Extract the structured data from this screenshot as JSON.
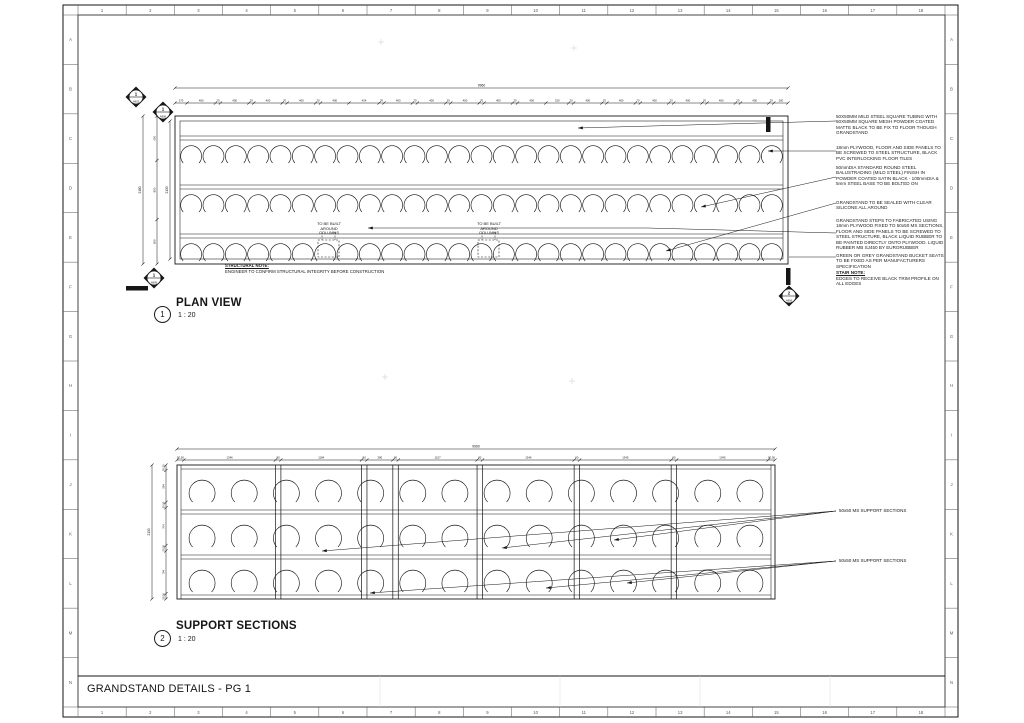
{
  "sheet": {
    "title": "GRANDSTAND DETAILS - PG 1",
    "grid_numbers": [
      "1",
      "2",
      "3",
      "4",
      "5",
      "6",
      "7",
      "8",
      "9",
      "10",
      "11",
      "12",
      "13",
      "14",
      "15",
      "16",
      "17",
      "18"
    ],
    "grid_letters": [
      "A",
      "B",
      "C",
      "D",
      "E",
      "F",
      "G",
      "H",
      "I",
      "J",
      "K",
      "L",
      "M",
      "N"
    ]
  },
  "views": {
    "plan": {
      "number": "1",
      "title": "PLAN VIEW",
      "scale": "1 : 20"
    },
    "support": {
      "number": "2",
      "title": "SUPPORT SECTIONS",
      "scale": "1 : 20"
    }
  },
  "notes": [
    {
      "text": "50X50MM MILD STEEL SQUARE TUBING WITH 50X50MM SQUARE MESH POWDER COATED MATTE BLACK TO BE FIX TO FLOOR THOUGH GRANDSTAND"
    },
    {
      "text": "18mm PLYWOOD, FLOOR AND SIDE PANELS TO BE SCREWED TO STEEL STRUCTURE, BLACK PVC INTERLOCKING FLOOR TILES"
    },
    {
      "text": "50mmDIA STANDARD ROUND STEEL BALUSTRADING (MILD STEEL) FINISH IN POWDER COATED SATIN BLACK - 100mmDIA & 5mm STEEL BASE TO BE BOLTED ON"
    },
    {
      "text": "GRANDSTAND TO BE SEALED WITH CLEAR SILICONE ALL AROUND"
    },
    {
      "text": "GRANDSTAND STEPS TO FABRICATED USING 18mm PLYWOOD FIXED TO 50x50 MS SECTIONS, FLOOR AND SIDE PANELS TO BE SCREWED TO STEEL STRUCTURE, BLACK LIQUID RUBBER TO BE PAINTED DIRECTLY ONTO PLYWOOD. LIQUID RUBBER MB SJ450 BY EURORUBBER"
    },
    {
      "text": "GREEN OR GREY GRANDSTAND BUCKET SEATS TO BE FIXED AS PER MANUFACTURERS SPECIFICATION"
    }
  ],
  "annotations": {
    "stair_note_title": "STAIR NOTE:",
    "stair_note_body": "EDGES TO RECEIVE BLACK TRIM PROFILE ON ALL EDGES",
    "column_note_1": "TO BE BUILT AROUND COLUMNS",
    "column_note_2": "TO BE BUILT AROUND COLUMNS",
    "structural_note_title": "STRUCTURAL NOTE:",
    "structural_note_body": "ENGINEER TO CONFIRM STRUCTURAL INTEGRITY BEFORE CONSTRUCTION",
    "support_label_1": "50x50 MS SUPPORT SECTIONS",
    "support_label_2": "50x50 MS SUPPORT SECTIONS"
  },
  "markers": [
    {
      "num": "1",
      "ref": "A902"
    },
    {
      "num": "1",
      "ref": "A906"
    },
    {
      "num": "1",
      "ref": "A906"
    },
    {
      "num": "2",
      "ref": "A906"
    }
  ],
  "dimensions": {
    "plan": {
      "total": "9960",
      "top_labels": [
        "170",
        "400",
        "70",
        "400",
        "70",
        "400",
        "70",
        "400",
        "70",
        "400",
        "424",
        "70",
        "400",
        "70",
        "400",
        "70",
        "400",
        "70",
        "400",
        "70",
        "400",
        "320",
        "70",
        "400",
        "70",
        "400",
        "70",
        "400",
        "70",
        "400",
        "70",
        "400",
        "70",
        "400",
        "70",
        "200"
      ],
      "top_values": [
        170,
        400,
        70,
        400,
        70,
        400,
        70,
        400,
        70,
        400,
        424,
        70,
        400,
        70,
        400,
        70,
        400,
        70,
        400,
        70,
        400,
        320,
        70,
        400,
        70,
        400,
        70,
        400,
        70,
        400,
        70,
        400,
        70,
        400,
        70,
        200
      ],
      "left_total": "2180",
      "left_labels": [
        "600",
        "800",
        "600"
      ],
      "left_values": [
        600,
        800,
        600
      ],
      "left_inner_total": "2130"
    },
    "support": {
      "total": "9960",
      "top_labels": [
        "50,50",
        "1346",
        "80",
        "1184",
        "80",
        "380",
        "80",
        "1157",
        "80",
        "1346",
        "80",
        "1345",
        "80",
        "1345",
        "80,50"
      ],
      "top_values": [
        100,
        1346,
        80,
        1184,
        80,
        380,
        80,
        1157,
        80,
        1346,
        80,
        1345,
        80,
        1345,
        100
      ],
      "left_total": "2130",
      "left_labels": [
        "50,50",
        "594",
        "50,50",
        "704",
        "50,50",
        "794",
        "50,50"
      ],
      "left_values": [
        100,
        594,
        100,
        704,
        100,
        794,
        100
      ]
    }
  },
  "drawing": {
    "plan_rows": 3,
    "plan_seats_per_row": 27,
    "support_rows": 3,
    "support_seats_per_row": 14,
    "line_color": "#161616",
    "grid_color": "#555555",
    "faint_color": "#c9c9c9"
  }
}
